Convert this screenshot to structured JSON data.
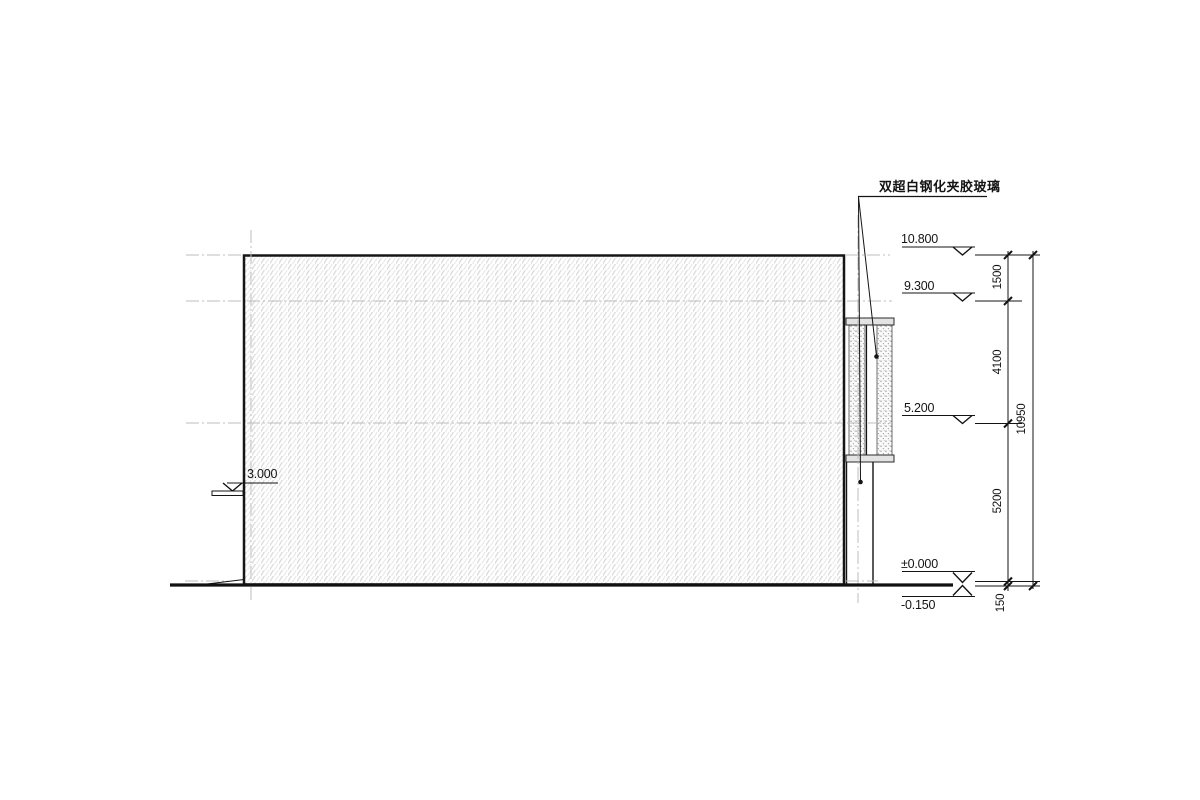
{
  "annotation": {
    "glass_note": "双超白钢化夹胶玻璃"
  },
  "levels": {
    "roof": "10.800",
    "parapet": "9.300",
    "mid": "5.200",
    "canopy": "3.000",
    "zero": "±0.000",
    "below_grade": "-0.150"
  },
  "dims": {
    "seg_top": "1500",
    "seg_upper": "4100",
    "seg_lower": "5200",
    "seg_base": "150",
    "overall": "10950"
  },
  "colors": {
    "line": "#141414",
    "centerline": "#bcbcbc",
    "hatch": "#dcdcdc",
    "cap_fill": "#e3e3e3",
    "stipple": "#8f8f8f"
  }
}
